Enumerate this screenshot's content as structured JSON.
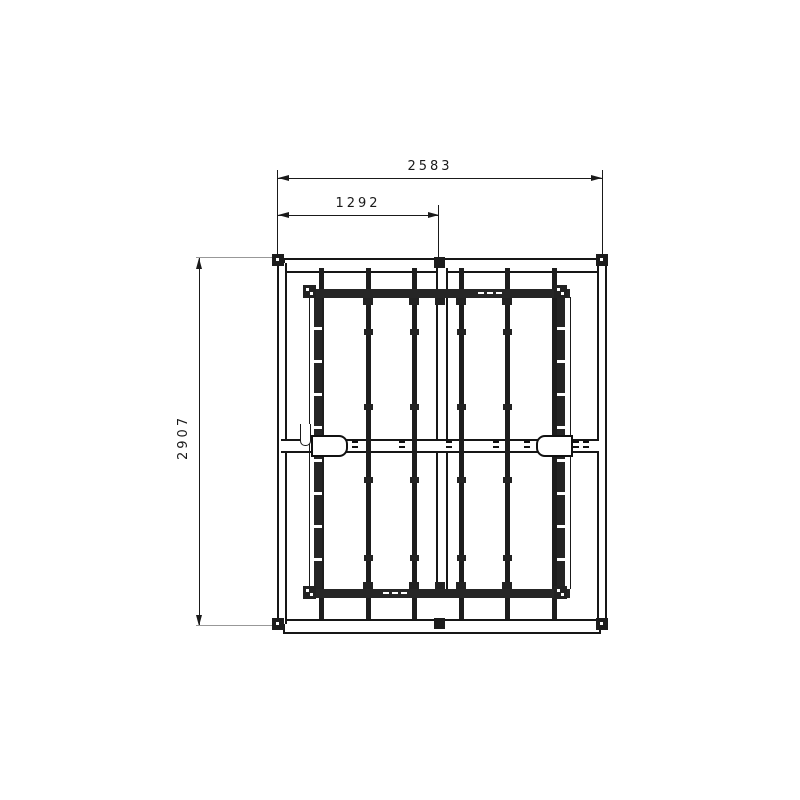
{
  "drawing": {
    "description": "CAD top-view drawing of rectangular frame assembly with vertical members and dimension annotations",
    "dimensions": {
      "width_total": "2583",
      "width_to_center": "1292",
      "height_total": "2907"
    },
    "colors": {
      "background": "#ffffff",
      "line": "#1a1a1a",
      "extension_line": "#989898",
      "member_fill": "#262626"
    }
  }
}
